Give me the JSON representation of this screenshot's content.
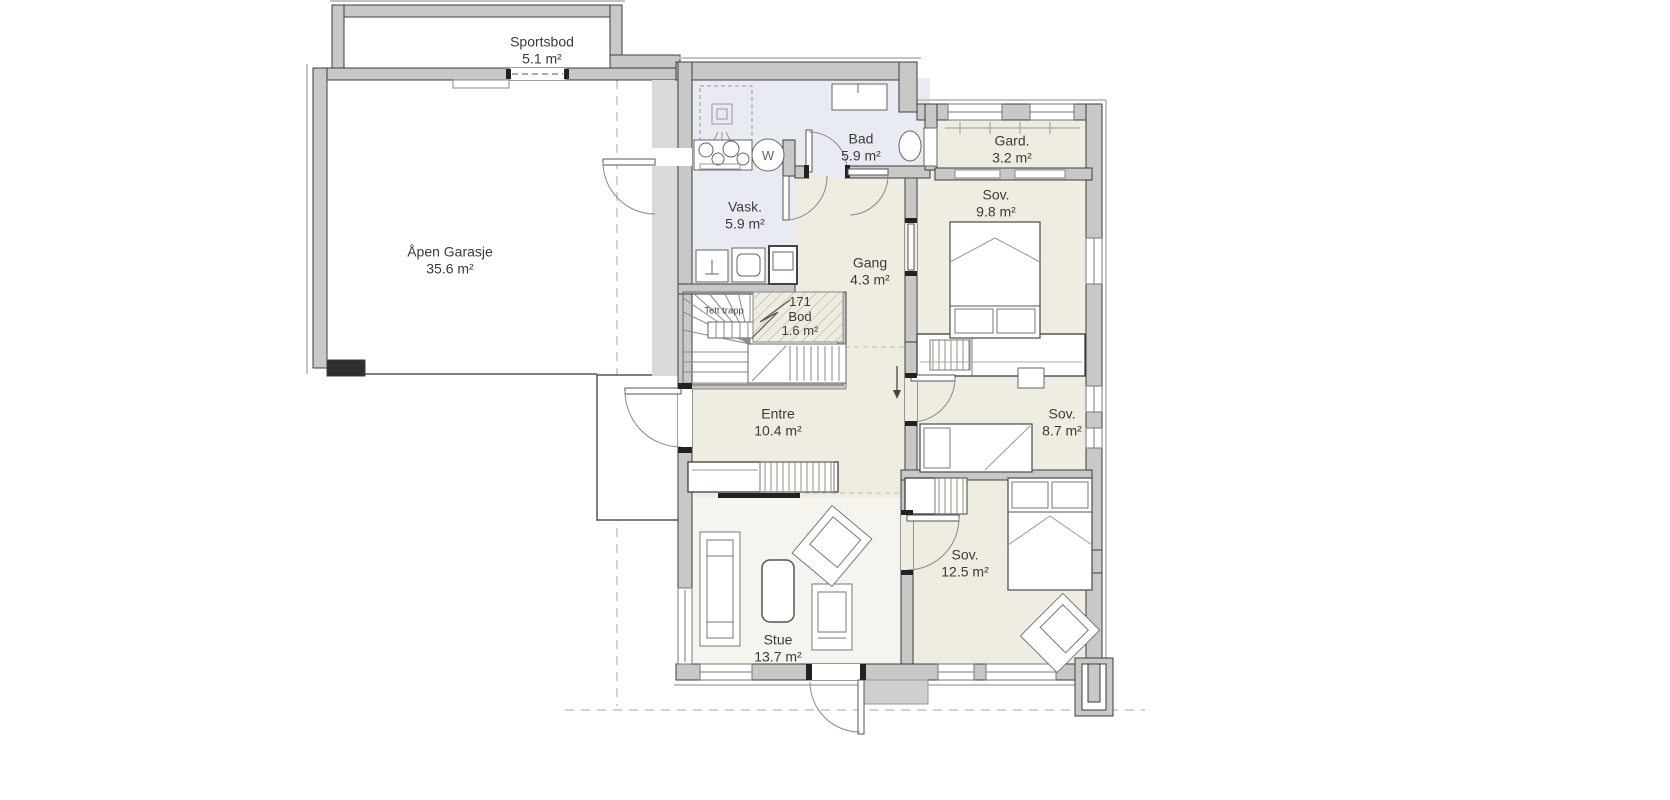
{
  "plan": {
    "type": "residential floor plan",
    "language": "Norwegian"
  },
  "rooms": [
    {
      "id": "sportsbod",
      "name": "Sportsbod",
      "area": "5.1 m²"
    },
    {
      "id": "garage",
      "name": "Åpen Garasje",
      "area": "35.6 m²"
    },
    {
      "id": "vask",
      "name": "Vask.",
      "area": "5.9 m²"
    },
    {
      "id": "bad",
      "name": "Bad",
      "area": "5.9 m²"
    },
    {
      "id": "gard",
      "name": "Gard.",
      "area": "3.2 m²"
    },
    {
      "id": "sov-1",
      "name": "Sov.",
      "area": "9.8 m²"
    },
    {
      "id": "gang",
      "name": "Gang",
      "area": "4.3 m²"
    },
    {
      "id": "bod",
      "number": "171",
      "name": "Bod",
      "area": "1.6 m²"
    },
    {
      "id": "entre",
      "name": "Entre",
      "area": "10.4 m²"
    },
    {
      "id": "sov-2",
      "name": "Sov.",
      "area": "8.7 m²"
    },
    {
      "id": "sov-3",
      "name": "Sov.",
      "area": "12.5 m²"
    },
    {
      "id": "stue",
      "name": "Stue",
      "area": "13.7 m²"
    }
  ],
  "annotations": {
    "stair_label": "Tett trapp",
    "washer_symbol": "W"
  },
  "colors": {
    "wall_fill": "#c8c8c7",
    "wall_edge": "#3d3d3d",
    "room_beige": "#efede2",
    "room_bath_blue": "#e9ebf2",
    "room_stue": "#f5f4ee",
    "room_white": "#ffffff",
    "hatch": "#b3b09f",
    "dashed_line": "#b9b9b9",
    "text": "#3a3a3a"
  }
}
